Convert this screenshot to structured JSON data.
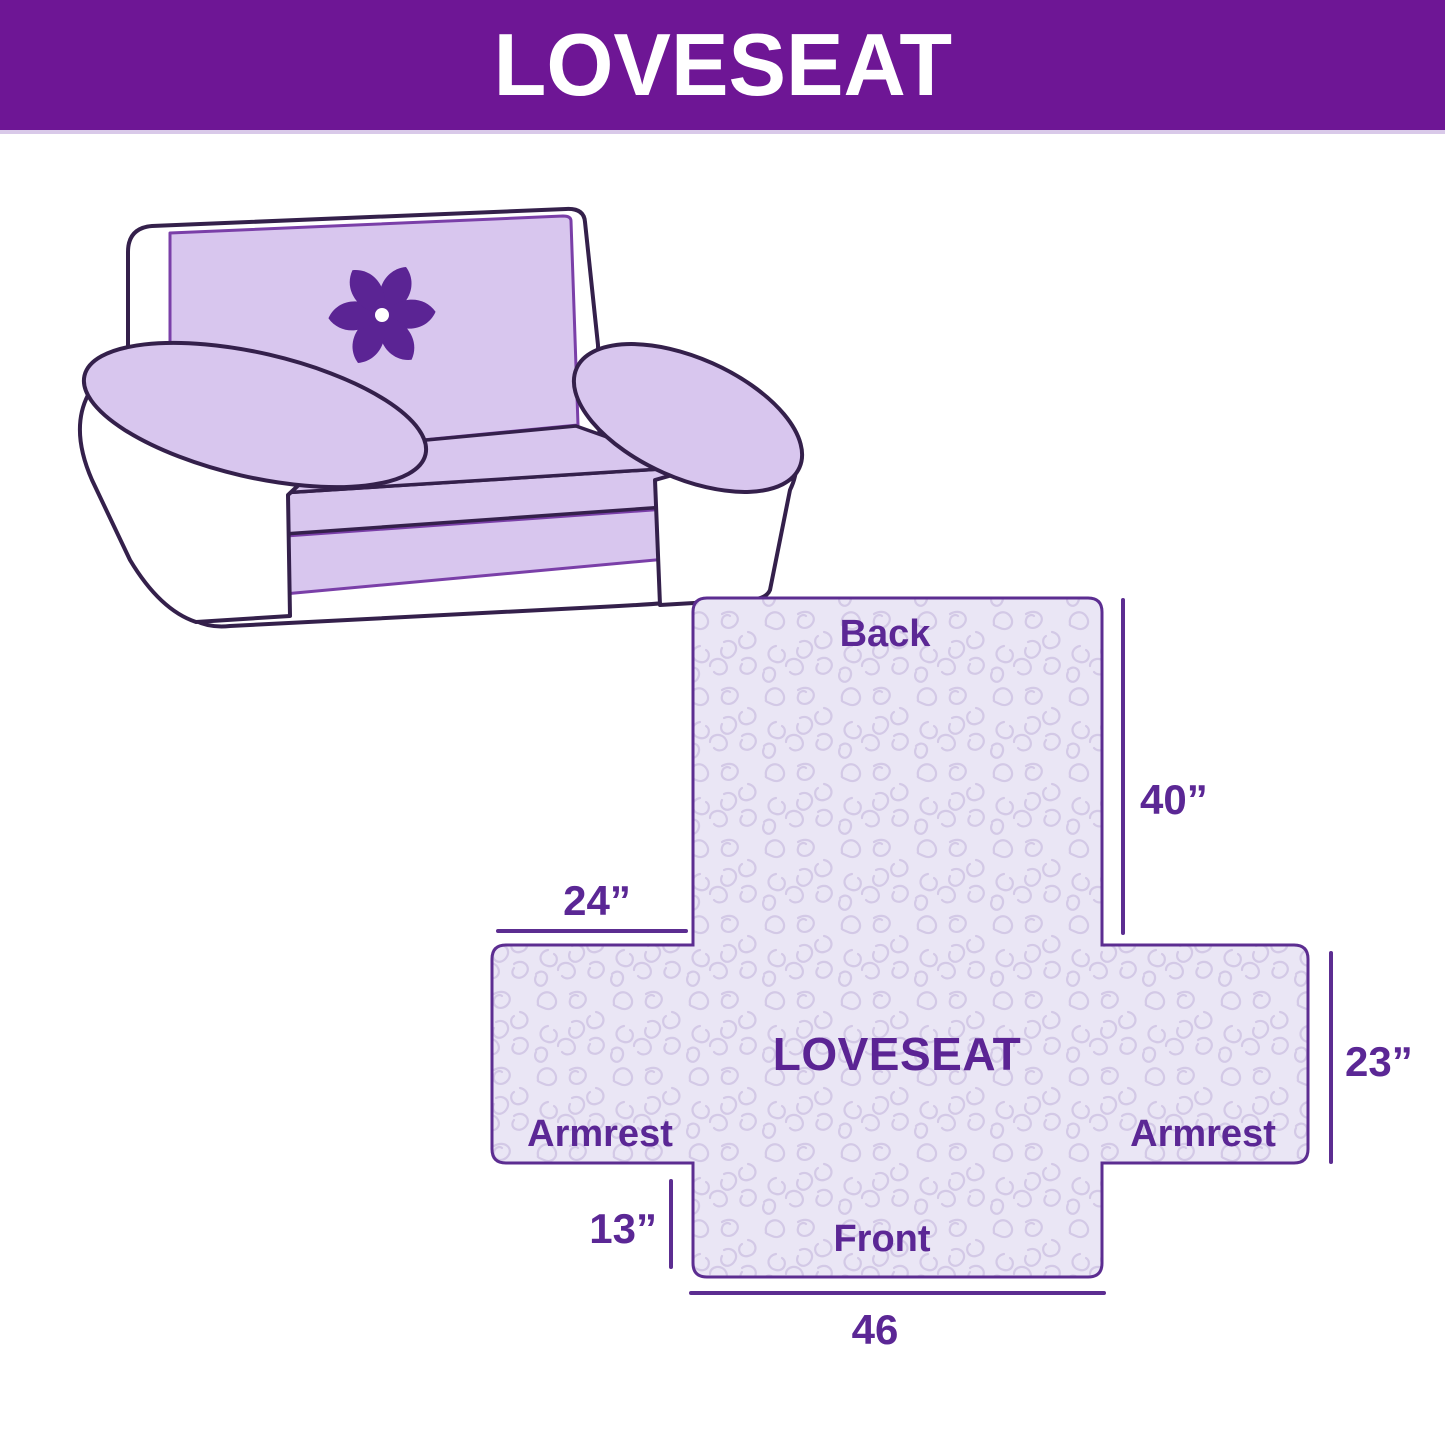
{
  "header": {
    "title": "LOVESEAT"
  },
  "illustration": {
    "alt": "Loveseat sofa with quilted slipcover",
    "logo_icon": "pinwheel-icon"
  },
  "diagram": {
    "center_label": "LOVESEAT",
    "labels": {
      "back": "Back",
      "front": "Front",
      "armrest_left": "Armrest",
      "armrest_right": "Armrest"
    },
    "dims": {
      "back_length": "40”",
      "armrest_top_width": "24”",
      "armrest_side_length": "23”",
      "front_drop": "13”",
      "front_width": "46"
    }
  },
  "colors": {
    "banner": "#6E1695",
    "banner_text": "#FFFFFF",
    "sofa_outline": "#34204B",
    "cover_lavender": "#D8C6EE",
    "cover_edge_purple": "#7A3FA8",
    "fabric_fill": "#EAE6F5",
    "fabric_pattern": "#D3C9E6",
    "diagram_ink": "#5B2795",
    "logo_purple": "#5B2494"
  }
}
